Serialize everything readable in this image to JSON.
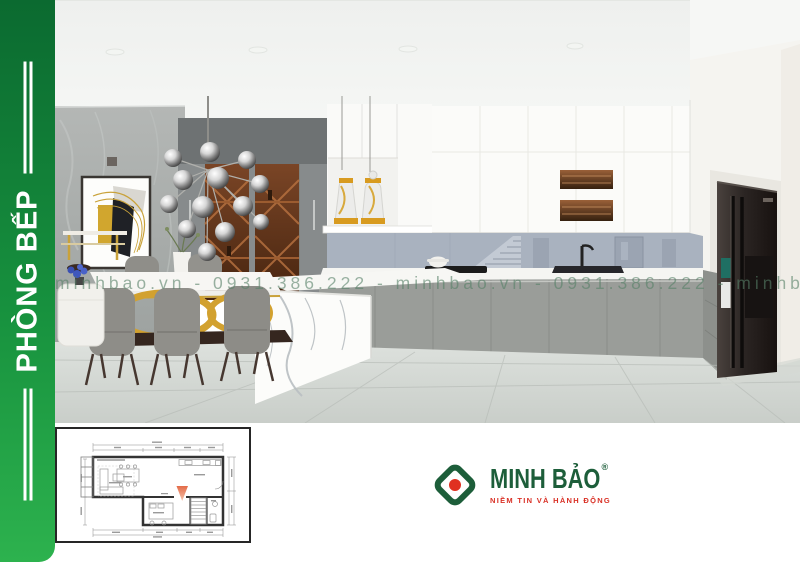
{
  "sidebar": {
    "label": "PHÒNG BẾP",
    "gradient_top": "#0b6a30",
    "gradient_bottom": "#2db24e",
    "text_color": "#ffffff"
  },
  "watermark": {
    "text": "minhbao.vn - 0931.386.222 - minhbao.vn - 0931.386.222 - minhbao.vn",
    "color": "#568068"
  },
  "logo": {
    "brand": "MINH BẢO",
    "registered_mark": "®",
    "tagline": "NIỀM TIN VÀ HÀNH ĐỘNG",
    "green": "#1d5e3a",
    "red": "#e03020"
  },
  "scene": {
    "accent_gold": "#d2a12f",
    "cabinet_gray": "#9a9d99",
    "backsplash_blue": "#a9b2bf",
    "marble_wall_gray": "#a8acab"
  },
  "floor_plan": {
    "camera_marker_color": "#e05a33",
    "wall_color": "#333333"
  }
}
